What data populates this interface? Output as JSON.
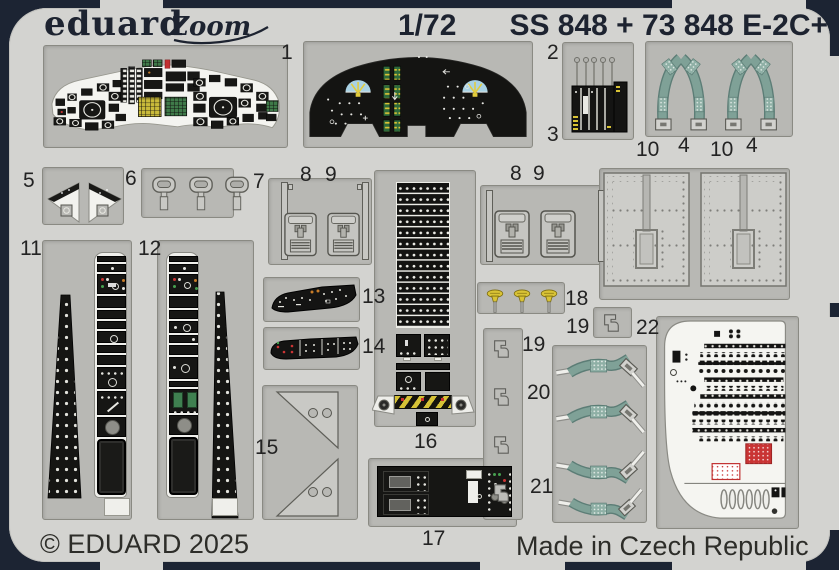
{
  "header": {
    "brand": "eduard",
    "series": "Zoom",
    "scale": "1/72",
    "code": "SS 848 + 73 848 E-2C+"
  },
  "footer": {
    "copyright": "© EDUARD 2025",
    "made_in": "Made in Czech Republic"
  },
  "labels": {
    "n1": "1",
    "n2": "2",
    "n3": "3",
    "n10a": "10",
    "n4a": "4",
    "n10b": "10",
    "n4b": "4",
    "n5": "5",
    "n6": "6",
    "n7": "7",
    "n8a": "8",
    "n9a": "9",
    "n8b": "8",
    "n9b": "9",
    "n11": "11",
    "n12": "12",
    "n13": "13",
    "n14": "14",
    "n15": "15",
    "n16": "16",
    "n17": "17",
    "n18": "18",
    "n19a": "19",
    "n22": "22",
    "n19b": "19",
    "n20": "20",
    "n21": "21"
  },
  "colors": {
    "frame": "#1c2433",
    "fret": "#d3d3d0",
    "recess": "#b8b8b4",
    "print_black": "#151513",
    "belt_green": "#7fa197",
    "handle_yellow": "#d9c335",
    "attitude_blue": "#a9d2e4",
    "warning_red": "#cc3434"
  }
}
